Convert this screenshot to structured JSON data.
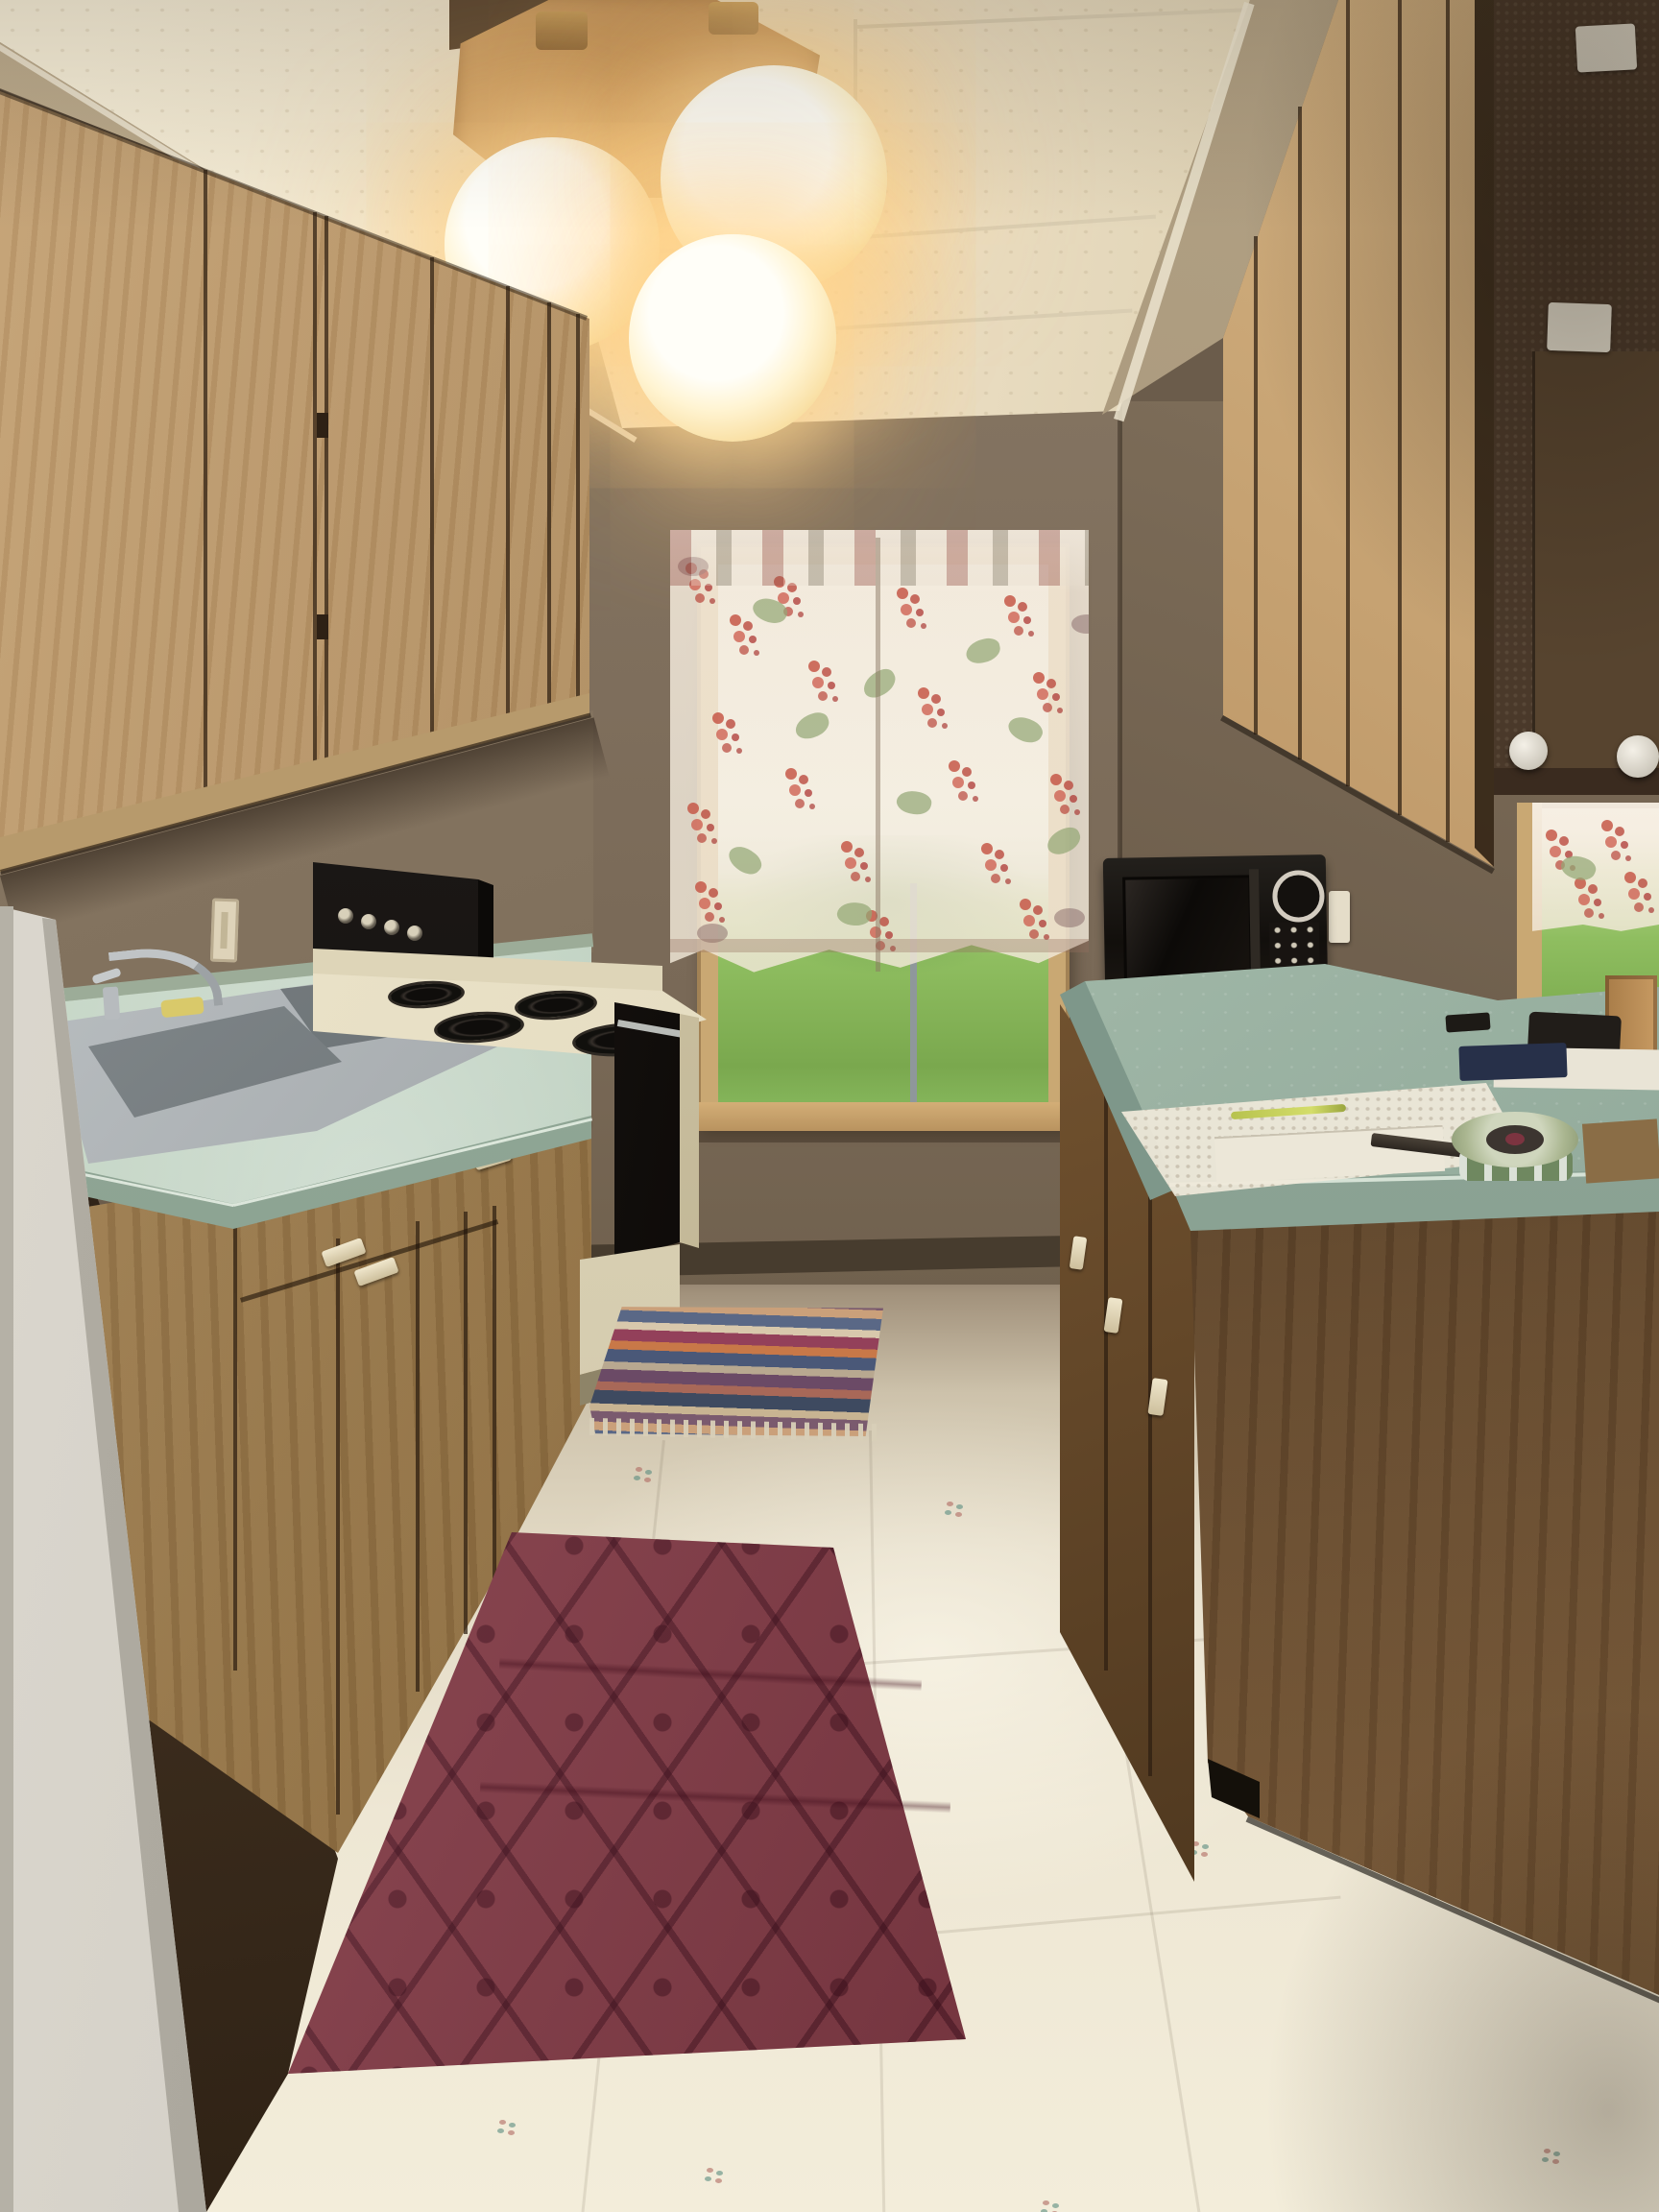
{
  "meta": {
    "title": "Galley kitchen interior photograph",
    "description": "Empty galley kitchen with oak cabinets, seafoam-green laminate counters, electric coil stove, black microwave, two floral-curtained windows, vinyl floor, burgundy diamond rug and striped rag rug, warm triple-globe ceiling light"
  },
  "palette": {
    "ceiling": "#ecdfc4",
    "ceiling_light": "#f6eed8",
    "soffit": "#b3a285",
    "wall": "#85755f",
    "wall_dark": "#5c4e3e",
    "oak": "#ad8a5c",
    "oak_dark": "#7d5c3b",
    "cork": "#4a392a",
    "counter": "#a9bfae",
    "counter_edge": "#7b9385",
    "steel": "#a8adb0",
    "stove_cream": "#ded5b8",
    "appliance_black": "#1b1815",
    "rug_red": "#93424f",
    "floor_light": "#eee7d4",
    "floor_mid": "#e2d9c4",
    "grass": "#8fbe60",
    "sky": "#f0f3ec",
    "curtain": "#f4ecdf",
    "grape_red": "#c65848",
    "leaf_green": "#94a876",
    "frame_tan": "#c9a873",
    "jamb": "#dcd8cf",
    "mahogany_light": "#7a5a38",
    "wood_fixture": "#d8a96c",
    "glow_warm": "#ffd695"
  },
  "objects": {
    "ceiling_light": {
      "label": "Triple globe ceiling light on wood base",
      "bulbs_lit": 3
    },
    "ceiling": {
      "label": "Textured drop-tile ceiling"
    },
    "center_window": {
      "label": "Back window with sheer grape-print curtain, lawn outside"
    },
    "right_window": {
      "label": "Right window with matching floral curtain"
    },
    "left_upper_cabinets": {
      "label": "Left oak upper cabinets"
    },
    "right_upper_cabinets": {
      "label": "Right oak upper cabinets"
    },
    "cork_panel": {
      "label": "Dark cabinet end panel with stickers and round knobs"
    },
    "sink": {
      "label": "Stainless double-basin sink with chrome faucet"
    },
    "left_counter": {
      "label": "Seafoam green laminate counter (left)"
    },
    "right_counter": {
      "label": "Seafoam green laminate peninsula counter (right)"
    },
    "stove": {
      "label": "Almond electric range with black coil burners and black oven door"
    },
    "microwave": {
      "label": "Black countertop microwave"
    },
    "doily": {
      "label": "White lace runner on counter"
    },
    "ribbon_spool": {
      "label": "Green ribbon spool"
    },
    "pen": {
      "label": "Yellow-green pen"
    },
    "paper": {
      "label": "Sheet of paper"
    },
    "red_rug": {
      "label": "Burgundy diamond-pattern area rug"
    },
    "striped_rug": {
      "label": "Multicolor striped rag rug with fringe"
    },
    "floor": {
      "label": "Cream vinyl floor with small flower motifs"
    },
    "door_jamb": {
      "label": "White door jamb in left foreground"
    },
    "light_switch": {
      "label": "Wall light switch"
    },
    "outlet": {
      "label": "Wall outlet"
    },
    "peninsula": {
      "label": "Brown peninsula side panel"
    }
  }
}
